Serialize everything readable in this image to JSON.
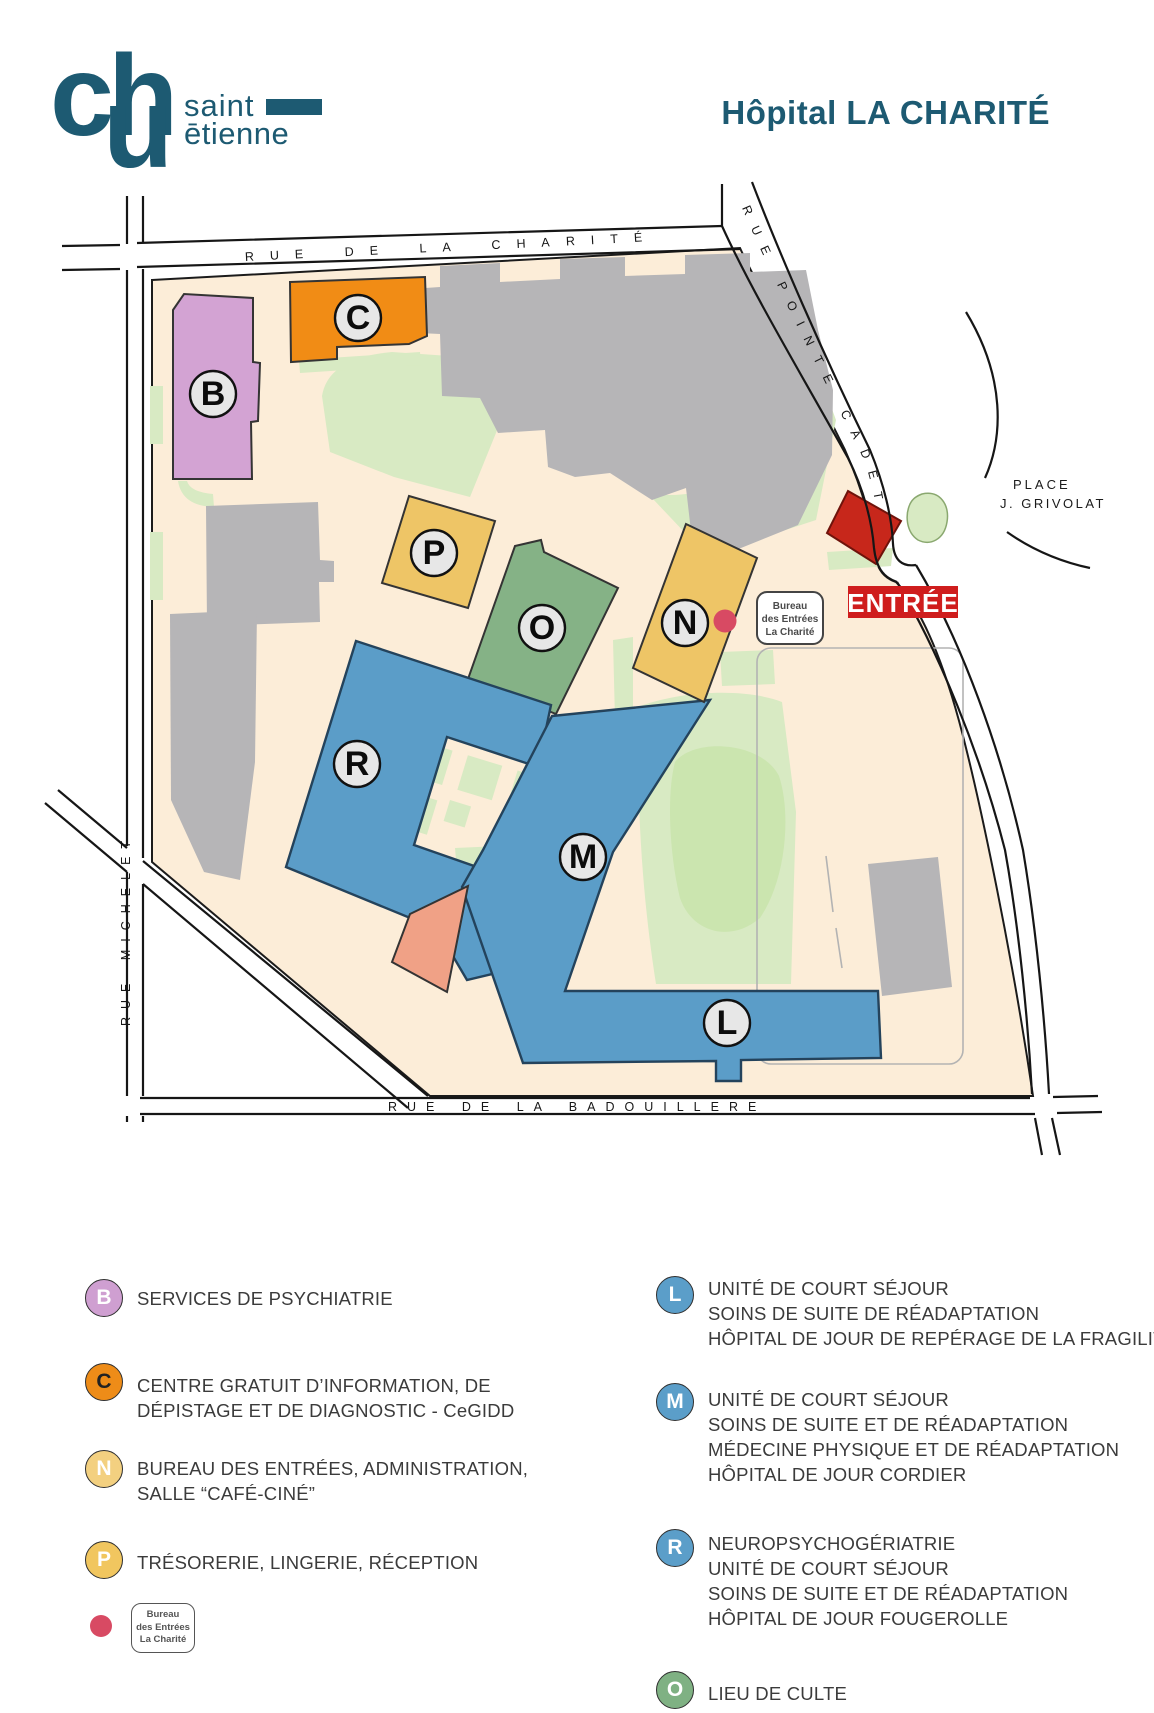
{
  "header": {
    "title": "Hôpital LA CHARITÉ",
    "accent_color": "#1d5a72",
    "logo": {
      "ch": "ch",
      "u": "u",
      "saint": "saint",
      "etienne": "ētienne"
    }
  },
  "map": {
    "streets": {
      "charite": "RUE DE LA CHARITÉ",
      "pointe_cadet": "RUE POINTE CADET",
      "michelet": "RUE MICHELET",
      "badouillere": "RUE DE LA BADOUILLERE",
      "place_line1": "PLACE",
      "place_line2": "J. GRIVOLAT"
    },
    "entrance": "ENTRÉE",
    "bureau": [
      "Bureau",
      "des Entrées",
      "La Charité"
    ],
    "buildings": {
      "b": "B",
      "c": "C",
      "p": "P",
      "o": "O",
      "n": "N",
      "r": "R",
      "m": "M",
      "l": "L"
    },
    "marker_color": "#d84a63",
    "colors": {
      "campus": "#fcedd8",
      "green": "#d8eac3",
      "gray_building": "#b6b5b7",
      "blue_building": "#5b9dc8",
      "gold_building": "#eec566",
      "orange_building": "#f18c15",
      "pink_building": "#d3a3d3",
      "chapel_green": "#85b286",
      "salmon_building": "#f0a186",
      "red_building": "#c7271b",
      "entrance_red": "#cf1d1d"
    }
  },
  "legend": {
    "left": [
      {
        "letter": "B",
        "color": "#cf9fd1",
        "text_color": "#ffffff",
        "lines": [
          "SERVICES DE PSYCHIATRIE"
        ]
      },
      {
        "letter": "C",
        "color": "#ee8c18",
        "text_color": "#222222",
        "lines": [
          "CENTRE GRATUIT D’INFORMATION, DE",
          "DÉPISTAGE ET DE DIAGNOSTIC - CeGIDD"
        ]
      },
      {
        "letter": "N",
        "color": "#f3d080",
        "text_color": "#ffffff",
        "lines": [
          "BUREAU DES ENTRÉES, ADMINISTRATION,",
          "SALLE “CAFÉ-CINÉ”"
        ]
      },
      {
        "letter": "P",
        "color": "#f1c65f",
        "text_color": "#ffffff",
        "lines": [
          "TRÉSORERIE, LINGERIE, RÉCEPTION"
        ]
      }
    ],
    "right": [
      {
        "letter": "L",
        "color": "#5b9ec9",
        "text_color": "#ffffff",
        "lines": [
          "UNITÉ DE COURT SÉJOUR",
          "SOINS DE SUITE DE RÉADAPTATION",
          "HÔPITAL DE JOUR DE REPÉRAGE DE LA FRAGILITÉ"
        ]
      },
      {
        "letter": "M",
        "color": "#5b9ec9",
        "text_color": "#ffffff",
        "lines": [
          "UNITÉ DE COURT SÉJOUR",
          "SOINS DE SUITE ET DE RÉADAPTATION",
          "MÉDECINE PHYSIQUE ET DE RÉADAPTATION",
          "HÔPITAL DE JOUR CORDIER"
        ]
      },
      {
        "letter": "R",
        "color": "#5b9ec9",
        "text_color": "#ffffff",
        "lines": [
          "NEUROPSYCHOGÉRIATRIE",
          "UNITÉ DE COURT SÉJOUR",
          "SOINS DE SUITE ET DE RÉADAPTATION",
          "HÔPITAL DE JOUR FOUGEROLLE"
        ]
      },
      {
        "letter": "O",
        "color": "#7fb183",
        "text_color": "#ffffff",
        "lines": [
          "LIEU DE CULTE"
        ]
      }
    ],
    "marker": {
      "color": "#d84a63",
      "box": [
        "Bureau",
        "des Entrées",
        "La Charité"
      ]
    }
  }
}
